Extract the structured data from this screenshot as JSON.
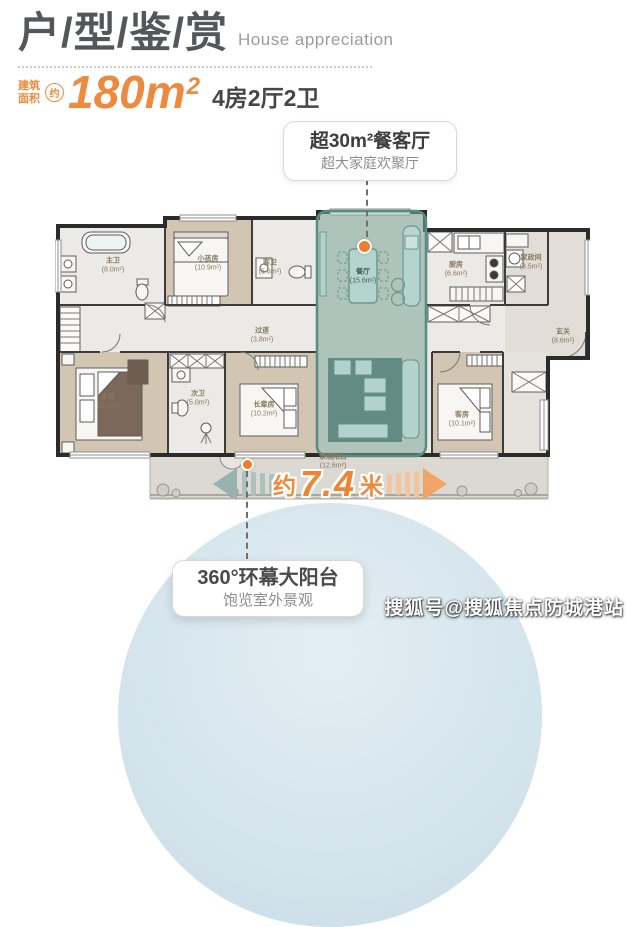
{
  "header": {
    "title": "户/型/鉴/赏",
    "subtitle": "House appreciation",
    "area_prefix_l1": "建筑",
    "area_prefix_l2": "面积",
    "approx": "约",
    "area_value": "180m",
    "area_sup": "2",
    "spec": "4房2厅2卫"
  },
  "callouts": {
    "dining": {
      "title": "超30m²餐客厅",
      "subtitle": "超大家庭欢聚厅"
    },
    "balcony": {
      "title": "360°环幕大阳台",
      "subtitle": "饱览室外景观"
    }
  },
  "dimension": {
    "prefix": "约",
    "value": "7.4",
    "unit": "米"
  },
  "floorplan": {
    "rooms": [
      {
        "name": "主卫",
        "area": "(8.0m²)"
      },
      {
        "name": "小孩房",
        "area": "(10.9m²)"
      },
      {
        "name": "客卫",
        "area": "(5.6m²)"
      },
      {
        "name": "过道",
        "area": "(3.8m²)"
      },
      {
        "name": "餐厅",
        "area": "(15.6m²)"
      },
      {
        "name": "厨房",
        "area": "(6.6m²)"
      },
      {
        "name": "家政间",
        "area": "(3.5m²)"
      },
      {
        "name": "玄关",
        "area": "(8.6m²)"
      },
      {
        "name": "主卧",
        "area": "22.3m²"
      },
      {
        "name": "次卫",
        "area": "(5.0m²)"
      },
      {
        "name": "长辈房",
        "area": "(10.2m²)"
      },
      {
        "name": "客房",
        "area": "(10.1m²)"
      },
      {
        "name": "景观阳台",
        "area": "(12.6m²)"
      }
    ]
  },
  "watermark": "搜狐号@搜狐焦点防城港站",
  "colors": {
    "accent_orange": "#ee8a3d",
    "highlight_teal": "#8fbcb3",
    "teal_border": "#558c84",
    "circle_blue": "#d4e4ec",
    "wall": "#2b2b2b"
  }
}
